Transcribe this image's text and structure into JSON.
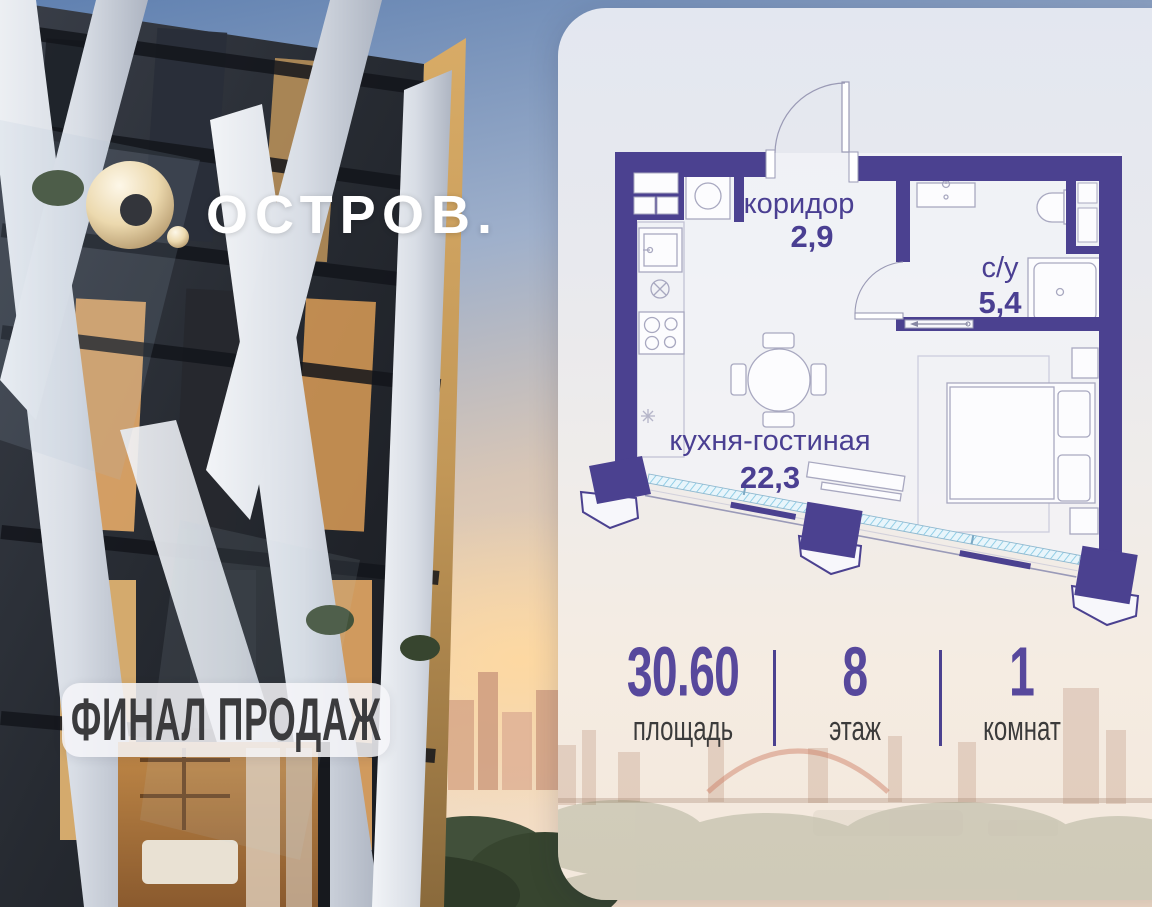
{
  "brand": {
    "name": "ОСТРОВ."
  },
  "badge": {
    "label": "ФИНАЛ ПРОДАЖ"
  },
  "floorplan": {
    "rooms": [
      {
        "name": "коридор",
        "area": "2,9"
      },
      {
        "name": "с/у",
        "area": "5,4"
      },
      {
        "name": "кухня-гостиная",
        "area": "22,3"
      }
    ]
  },
  "stats": [
    {
      "value": "30.60",
      "label": "площадь"
    },
    {
      "value": "8",
      "label": "этаж"
    },
    {
      "value": "1",
      "label": "комнат"
    }
  ],
  "colors": {
    "wall": "#4b4190",
    "plan_label": "#4a3f92",
    "stat_value": "#57489c",
    "stat_label": "#3b3b3b",
    "glazing": "#7fc6e2",
    "logo_gold": "#e3cfa0"
  }
}
